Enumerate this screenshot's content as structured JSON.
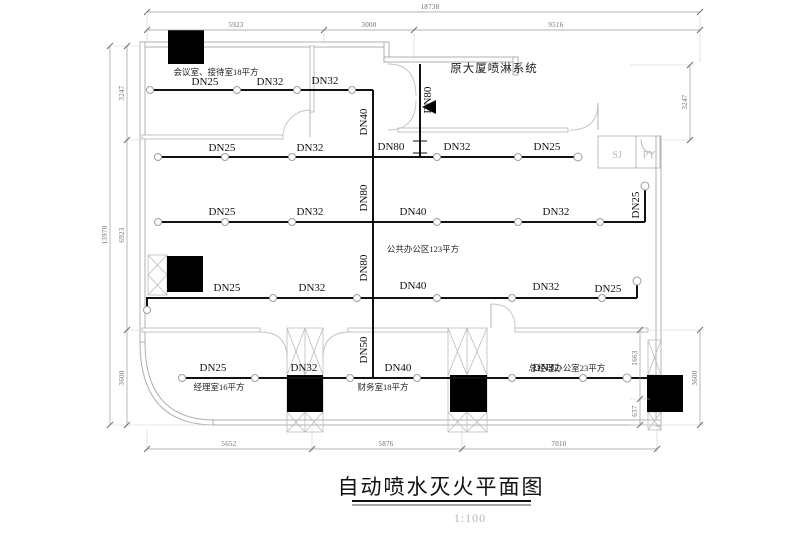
{
  "title": {
    "text": "自动喷水灭火平面图",
    "scale": "1:100"
  },
  "rooms": {
    "meeting": "会议室、接待室18平方",
    "existing_system": "原大厦喷淋系统",
    "public_office": "公共办公区123平方",
    "manager": "经理室16平方",
    "finance": "财务室18平方",
    "gm_office": "总经理办公室23平方",
    "shaft_sj": "SJ",
    "shaft_py": "PY"
  },
  "pipes": {
    "row1": [
      "DN25",
      "DN32",
      "DN32"
    ],
    "row2": [
      "DN25",
      "DN32",
      "DN80",
      "DN32",
      "DN25"
    ],
    "row3": [
      "DN25",
      "DN32",
      "DN40",
      "DN32",
      "DN25"
    ],
    "row4": [
      "DN25",
      "DN32",
      "DN40",
      "DN32",
      "DN25"
    ],
    "row5": [
      "DN25",
      "DN32",
      "DN40",
      "DN32"
    ],
    "riser": [
      "DN40",
      "DN80",
      "DN80",
      "DN50"
    ],
    "feed": "DN80"
  },
  "dimensions": {
    "top_total": "18738",
    "top_segments": [
      "5923",
      "3000",
      "9516"
    ],
    "left_total": "13970",
    "left_segments": [
      "3247",
      "6923",
      "3600"
    ],
    "right_top": "3247",
    "right_mid": "1663",
    "right_low": "637",
    "right_bottom": "3600",
    "bottom_segments": [
      "5652",
      "5876",
      "7010"
    ]
  }
}
